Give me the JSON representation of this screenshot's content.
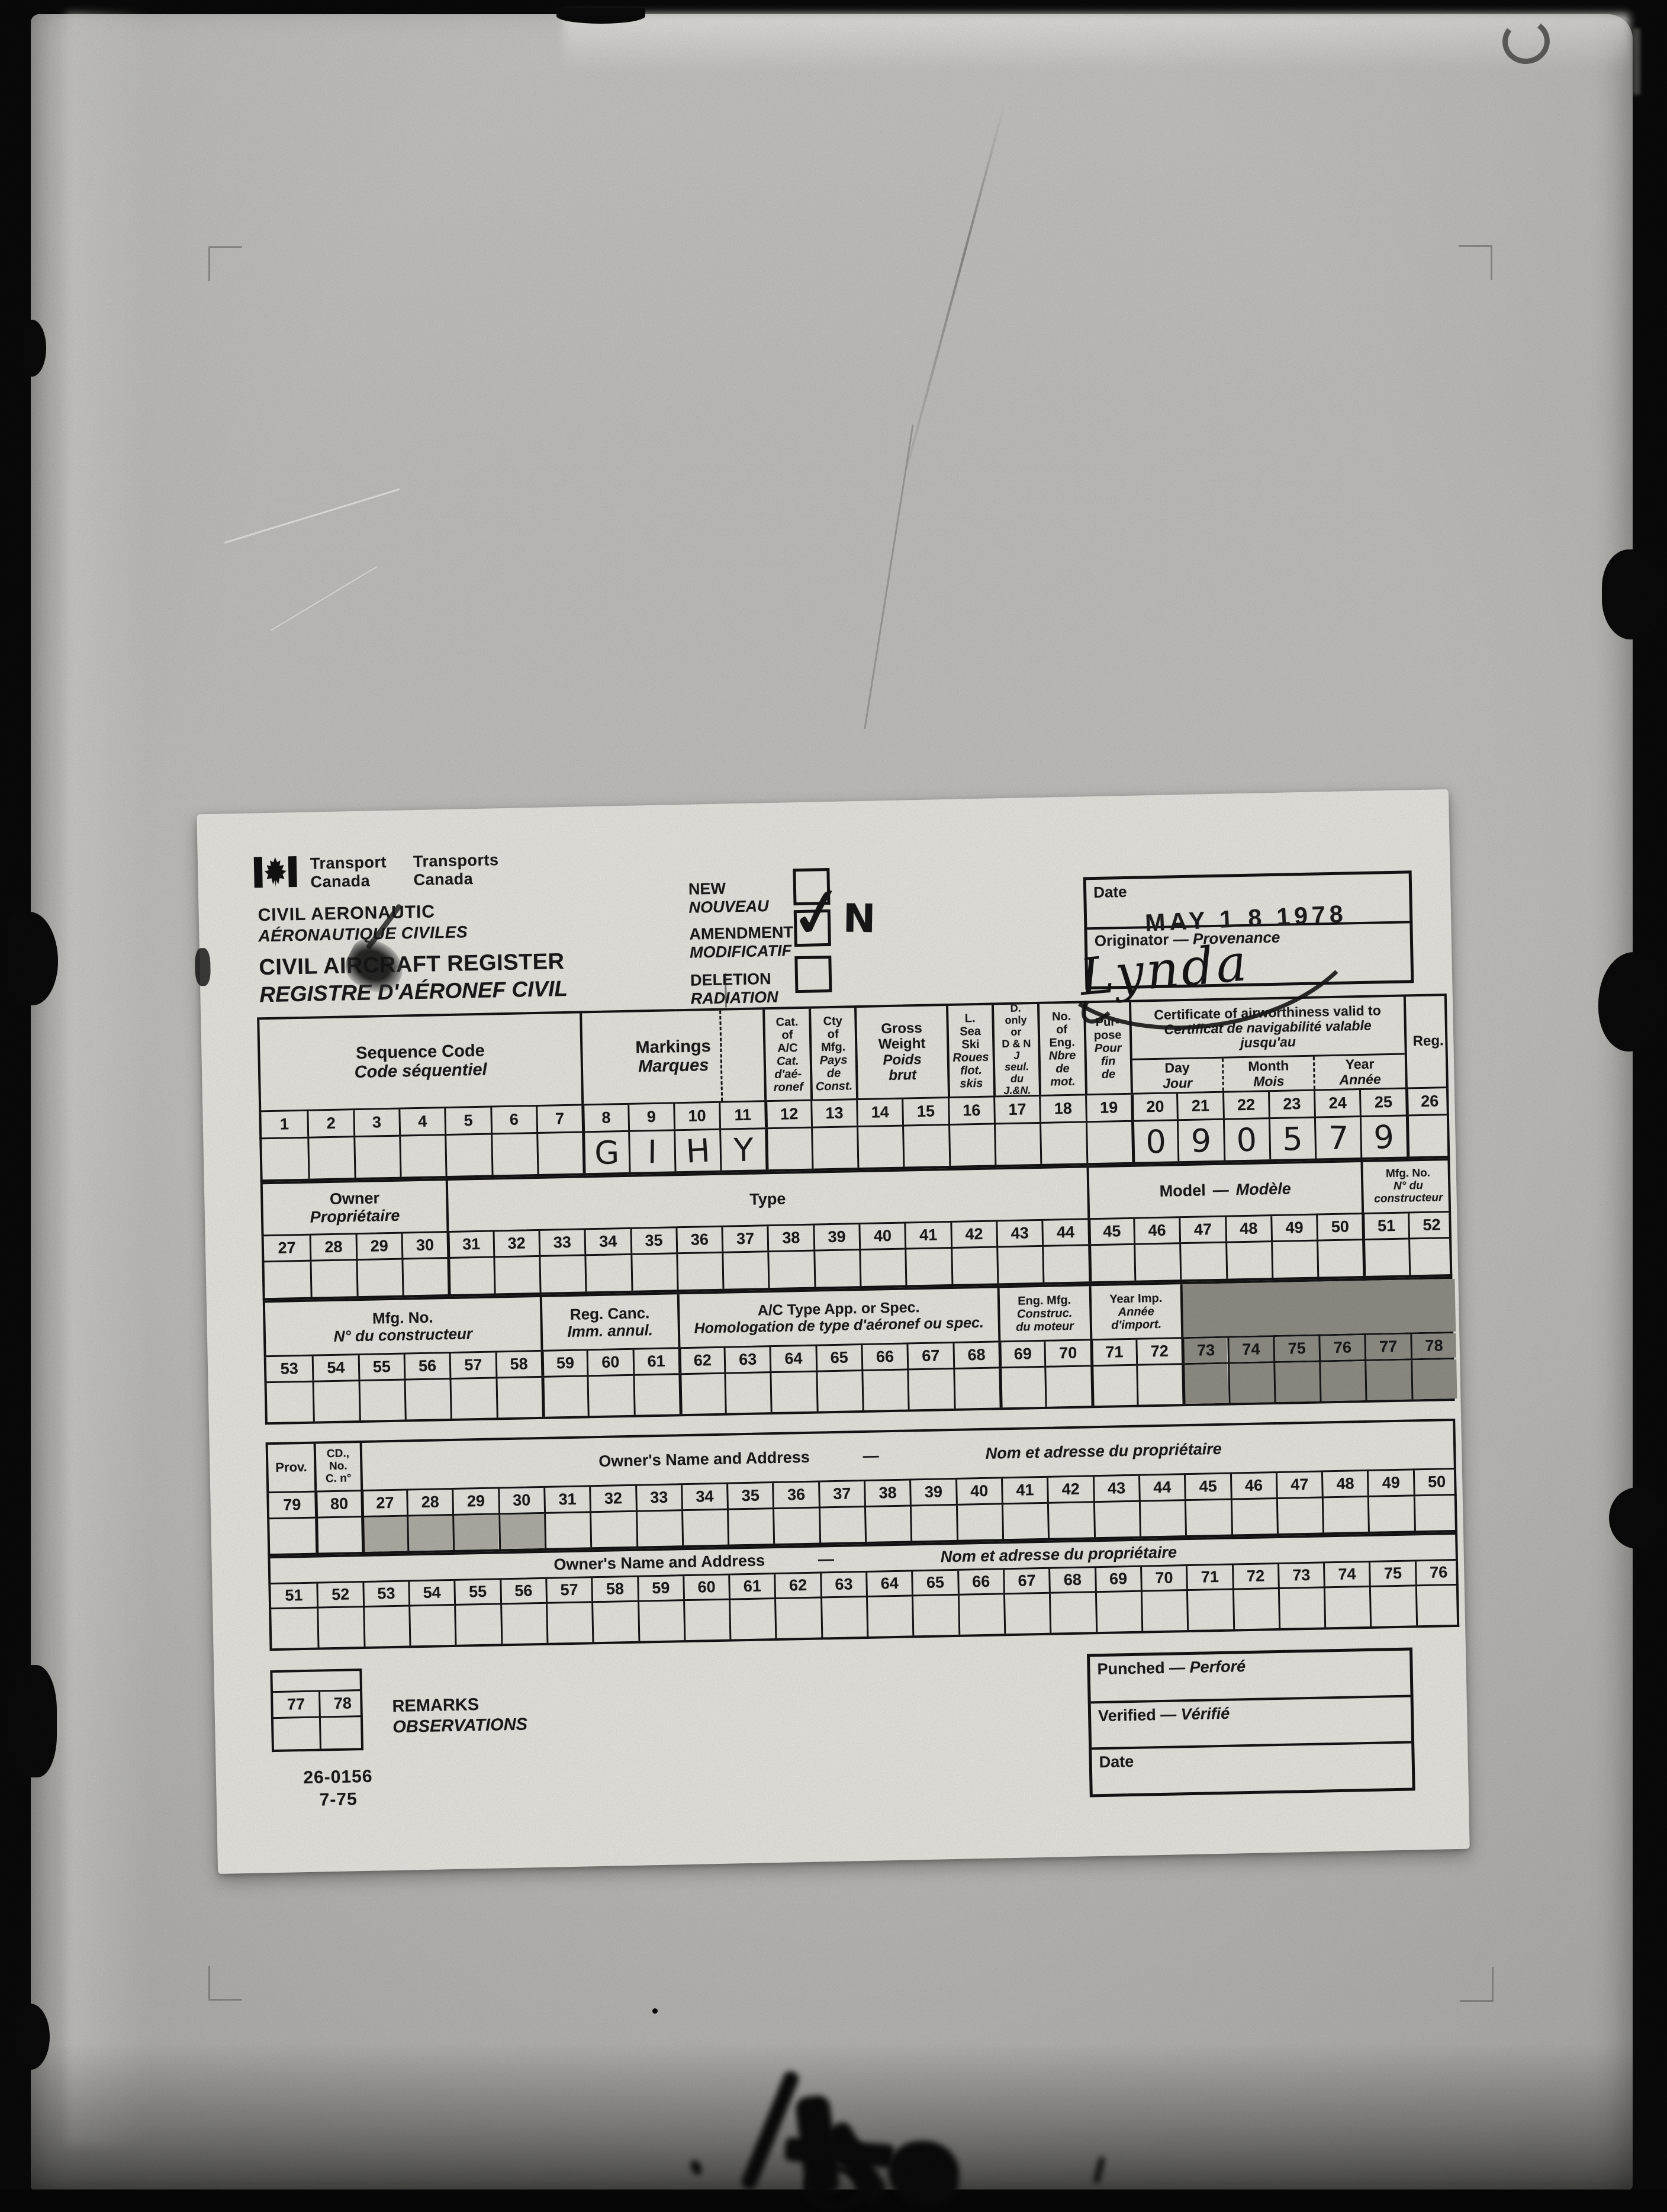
{
  "ui": {
    "dash": "—",
    "check_mark": "✓"
  },
  "colors": {
    "paper": "#f3f2ec",
    "copy_background": "#c9c8c4",
    "line": "#141414",
    "shade_dark": "#98958d",
    "shade_light": "#bab7b0"
  },
  "header": {
    "wordmark_en1": "Transport",
    "wordmark_en2": "Canada",
    "wordmark_fr1": "Transports",
    "wordmark_fr2": "Canada",
    "dept_en": "CIVIL AERONAUTIC",
    "dept_fr": "AÉRONAUTIQUE CIVILES",
    "title_en": "CIVIL AIRCRAFT REGISTER",
    "title_fr": "REGISTRE D'AÉRONEF CIVIL",
    "checkboxes": [
      {
        "en": "NEW",
        "fr": "NOUVEAU",
        "checked": false
      },
      {
        "en": "AMENDMENT",
        "fr": "MODIFICATIF",
        "checked": true,
        "annotation": "N"
      },
      {
        "en": "DELETION",
        "fr": "RADIATION",
        "checked": false
      }
    ],
    "date_label": "Date",
    "date_stamp": "MAY 1 8 1978",
    "originator_en": "Originator",
    "originator_fr": "Provenance",
    "signature": "Lynda"
  },
  "bands": [
    {
      "name": "card-row-1",
      "numbers": [
        "1",
        "2",
        "3",
        "4",
        "5",
        "6",
        "7",
        "8",
        "9",
        "10",
        "11",
        "12",
        "13",
        "14",
        "15",
        "16",
        "17",
        "18",
        "19",
        "20",
        "21",
        "22",
        "23",
        "24",
        "25",
        "26"
      ],
      "values": {
        "7": "G",
        "8": "I",
        "9": "H",
        "10": "Y",
        "19": "0",
        "20": "9",
        "21": "0",
        "22": "5",
        "23": "7",
        "24": "9"
      },
      "thick": [
        7,
        11,
        19,
        25
      ],
      "sections": [
        {
          "c0": 0,
          "c1": 7,
          "en": "Sequence Code",
          "fr": "Code séquentiel",
          "fs": 29
        },
        {
          "c0": 7,
          "c1": 11,
          "en": "Markings",
          "fr": "Marques",
          "fs": 29,
          "dash_at": 3
        },
        {
          "c0": 11,
          "c1": 12,
          "en": "Cat.\nof\nA/C",
          "fr": "Cat.\nd'aé-\nronef",
          "fs": 20
        },
        {
          "c0": 12,
          "c1": 13,
          "en": "Cty\nof\nMfg.",
          "fr": "Pays\nde\nConst.",
          "fs": 20
        },
        {
          "c0": 13,
          "c1": 15,
          "en": "Gross\nWeight",
          "fr": "Poids\nbrut",
          "fs": 24
        },
        {
          "c0": 15,
          "c1": 16,
          "en": "L.\nSea\nSki",
          "fr": "Roues\nflot.\nskis",
          "fs": 20
        },
        {
          "c0": 16,
          "c1": 17,
          "en": "D.\nonly\nor\nD & N",
          "fr": "J\nseul.\ndu\nJ.&N.",
          "fs": 18
        },
        {
          "c0": 17,
          "c1": 18,
          "en": "No.\nof\nEng.",
          "fr": "Nbre\nde\nmot.",
          "fs": 20
        },
        {
          "c0": 18,
          "c1": 19,
          "en": "Pur-\npose",
          "fr": "Pour\nfin\nde",
          "fs": 20
        },
        {
          "c0": 19,
          "c1": 25,
          "cert": true,
          "en": "Certificate of airworthiness valid to",
          "fr": "Certificat de navigabilité valable\njusqu'au",
          "fs": 23,
          "subs": [
            {
              "en": "Day",
              "fr": "Jour"
            },
            {
              "en": "Month",
              "fr": "Mois"
            },
            {
              "en": "Year",
              "fr": "Année"
            }
          ]
        },
        {
          "c0": 25,
          "c1": 26,
          "en": "Reg.",
          "fr": "",
          "fs": 24
        }
      ]
    },
    {
      "name": "card-row-2",
      "numbers": [
        "27",
        "28",
        "29",
        "30",
        "31",
        "32",
        "33",
        "34",
        "35",
        "36",
        "37",
        "38",
        "39",
        "40",
        "41",
        "42",
        "43",
        "44",
        "45",
        "46",
        "47",
        "48",
        "49",
        "50",
        "51",
        "52"
      ],
      "thick": [
        4,
        18,
        24
      ],
      "sections": [
        {
          "c0": 0,
          "c1": 4,
          "en": "Owner",
          "fr": "Propriétaire",
          "fs": 27
        },
        {
          "c0": 4,
          "c1": 18,
          "en": "Type",
          "fr": "",
          "fs": 27
        },
        {
          "c0": 18,
          "c1": 24,
          "inline": true,
          "en": "Model",
          "fr": "Modèle",
          "fs": 27
        },
        {
          "c0": 24,
          "c1": 26,
          "en": "Mfg. No.",
          "fr": "N° du\nconstructeur",
          "fs": 19
        }
      ]
    },
    {
      "name": "card-row-3",
      "numbers": [
        "53",
        "54",
        "55",
        "56",
        "57",
        "58",
        "59",
        "60",
        "61",
        "62",
        "63",
        "64",
        "65",
        "66",
        "67",
        "68",
        "69",
        "70",
        "71",
        "72",
        "73",
        "74",
        "75",
        "76",
        "77",
        "78"
      ],
      "shade": [
        20,
        21,
        22,
        23,
        24,
        25
      ],
      "thick": [
        6,
        9,
        16,
        18,
        20
      ],
      "sections": [
        {
          "c0": 0,
          "c1": 6,
          "en": "Mfg. No.",
          "fr": "N° du constructeur",
          "fs": 26
        },
        {
          "c0": 6,
          "c1": 9,
          "en": "Reg. Canc.",
          "fr": "Imm. annul.",
          "fs": 26
        },
        {
          "c0": 9,
          "c1": 16,
          "en": "A/C Type App. or Spec.",
          "fr": "Homologation de type d'aéronef ou spec.",
          "fs": 25
        },
        {
          "c0": 16,
          "c1": 18,
          "en": "Eng. Mfg.",
          "fr": "Construc.\ndu moteur",
          "fs": 20
        },
        {
          "c0": 18,
          "c1": 20,
          "en": "Year Imp.",
          "fr": "Année\nd'import.",
          "fs": 20
        },
        {
          "c0": 20,
          "c1": 26,
          "en": "",
          "fr": "",
          "shaded": true
        }
      ]
    },
    {
      "name": "card-row-4",
      "numbers": [
        "79",
        "80",
        "27",
        "28",
        "29",
        "30",
        "31",
        "32",
        "33",
        "34",
        "35",
        "36",
        "37",
        "38",
        "39",
        "40",
        "41",
        "42",
        "43",
        "44",
        "45",
        "46",
        "47",
        "48",
        "49",
        "50"
      ],
      "shade_light": [
        2,
        3,
        4,
        5
      ],
      "thick": [
        1,
        2
      ],
      "sections": [
        {
          "c0": 0,
          "c1": 1,
          "en": "Prov.",
          "fr": "",
          "fs": 22
        },
        {
          "c0": 1,
          "c1": 2,
          "en": "CD.,\nNo.\nC. n°",
          "fr": "",
          "fs": 19
        },
        {
          "c0": 2,
          "c1": 26,
          "spread": true,
          "en": "Owner's Name and Address",
          "fr": "Nom et adresse du propriétaire",
          "fs": 27
        }
      ]
    },
    {
      "name": "card-row-5",
      "numbers": [
        "51",
        "52",
        "53",
        "54",
        "55",
        "56",
        "57",
        "58",
        "59",
        "60",
        "61",
        "62",
        "63",
        "64",
        "65",
        "66",
        "67",
        "68",
        "69",
        "70",
        "71",
        "72",
        "73",
        "74",
        "75",
        "76"
      ],
      "sections": [
        {
          "c0": 0,
          "c1": 26,
          "spread": true,
          "en": "Owner's Name and Address",
          "fr": "Nom et adresse du propriétaire",
          "fs": 27
        }
      ]
    },
    {
      "name": "card-row-6",
      "ncols": 2,
      "numbers": [
        "77",
        "78"
      ],
      "sections": [
        {
          "c0": 0,
          "c1": 2,
          "en": "",
          "fr": ""
        }
      ]
    }
  ],
  "remarks": {
    "en": "REMARKS",
    "fr": "OBSERVATIONS"
  },
  "punched": {
    "rows": [
      {
        "en": "Punched",
        "fr": "Perforé"
      },
      {
        "en": "Verified",
        "fr": "Vérifié"
      },
      {
        "en": "Date",
        "fr": ""
      }
    ]
  },
  "form_number": {
    "line1": "26-0156",
    "line2": "7-75"
  }
}
